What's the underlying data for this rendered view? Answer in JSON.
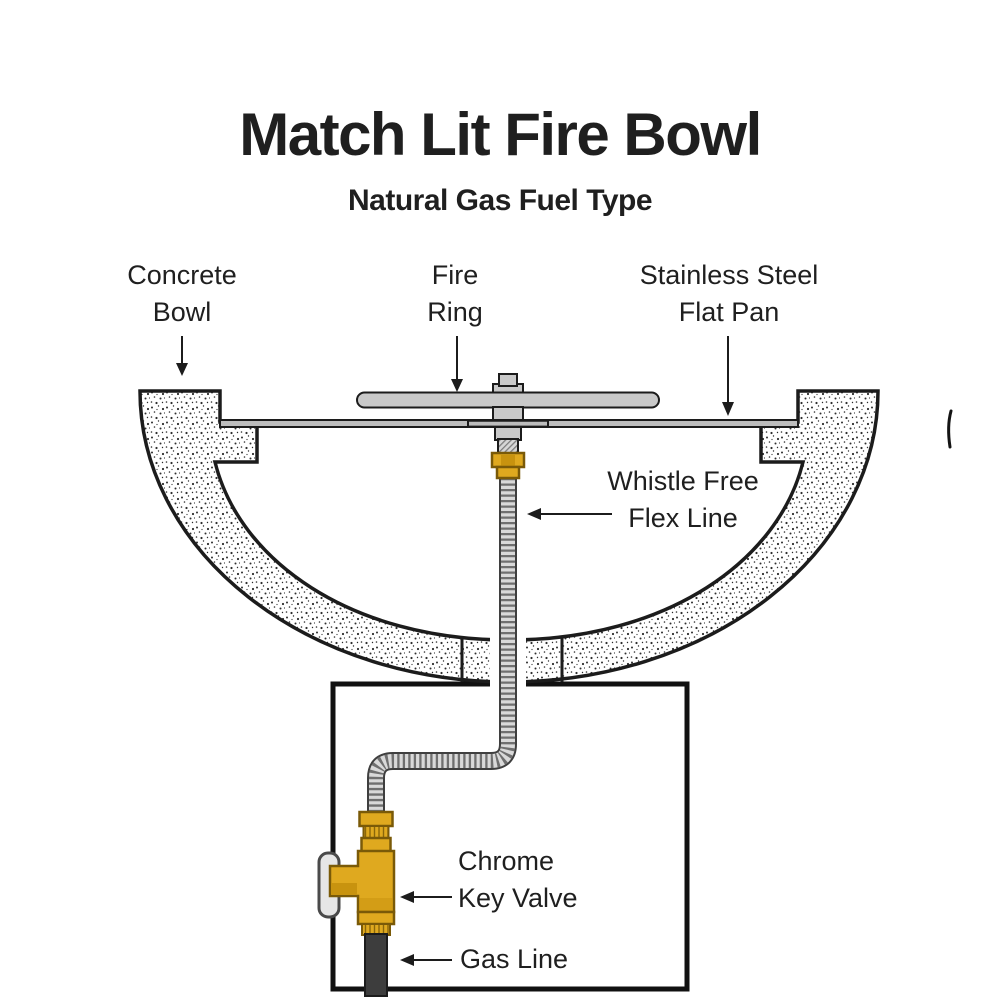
{
  "title": "Match Lit Fire Bowl",
  "subtitle": "Natural Gas Fuel Type",
  "labels": {
    "concrete_bowl": {
      "line1": "Concrete",
      "line2": "Bowl"
    },
    "fire_ring": {
      "line1": "Fire",
      "line2": "Ring"
    },
    "flat_pan": {
      "line1": "Stainless Steel",
      "line2": "Flat Pan"
    },
    "flex_line": {
      "line1": "Whistle Free",
      "line2": "Flex Line"
    },
    "key_valve": {
      "line1": "Chrome",
      "line2": "Key Valve"
    },
    "gas_line": {
      "line1": "Gas Line"
    }
  },
  "colors": {
    "text": "#1f1f1f",
    "outline": "#1c1c1c",
    "metal": "#c9c9c9",
    "metalLight": "#d9d9d9",
    "brass": "#dfa91f",
    "brassDark": "#7a5a08",
    "brassShade": "#c8930f",
    "gas": "#3d3d3d",
    "chrome": "#e6e6e6",
    "chromeStroke": "#4a4a4a",
    "tubeOutline": "#3f3f3f",
    "tubeStripe": "#6f6f6f"
  }
}
